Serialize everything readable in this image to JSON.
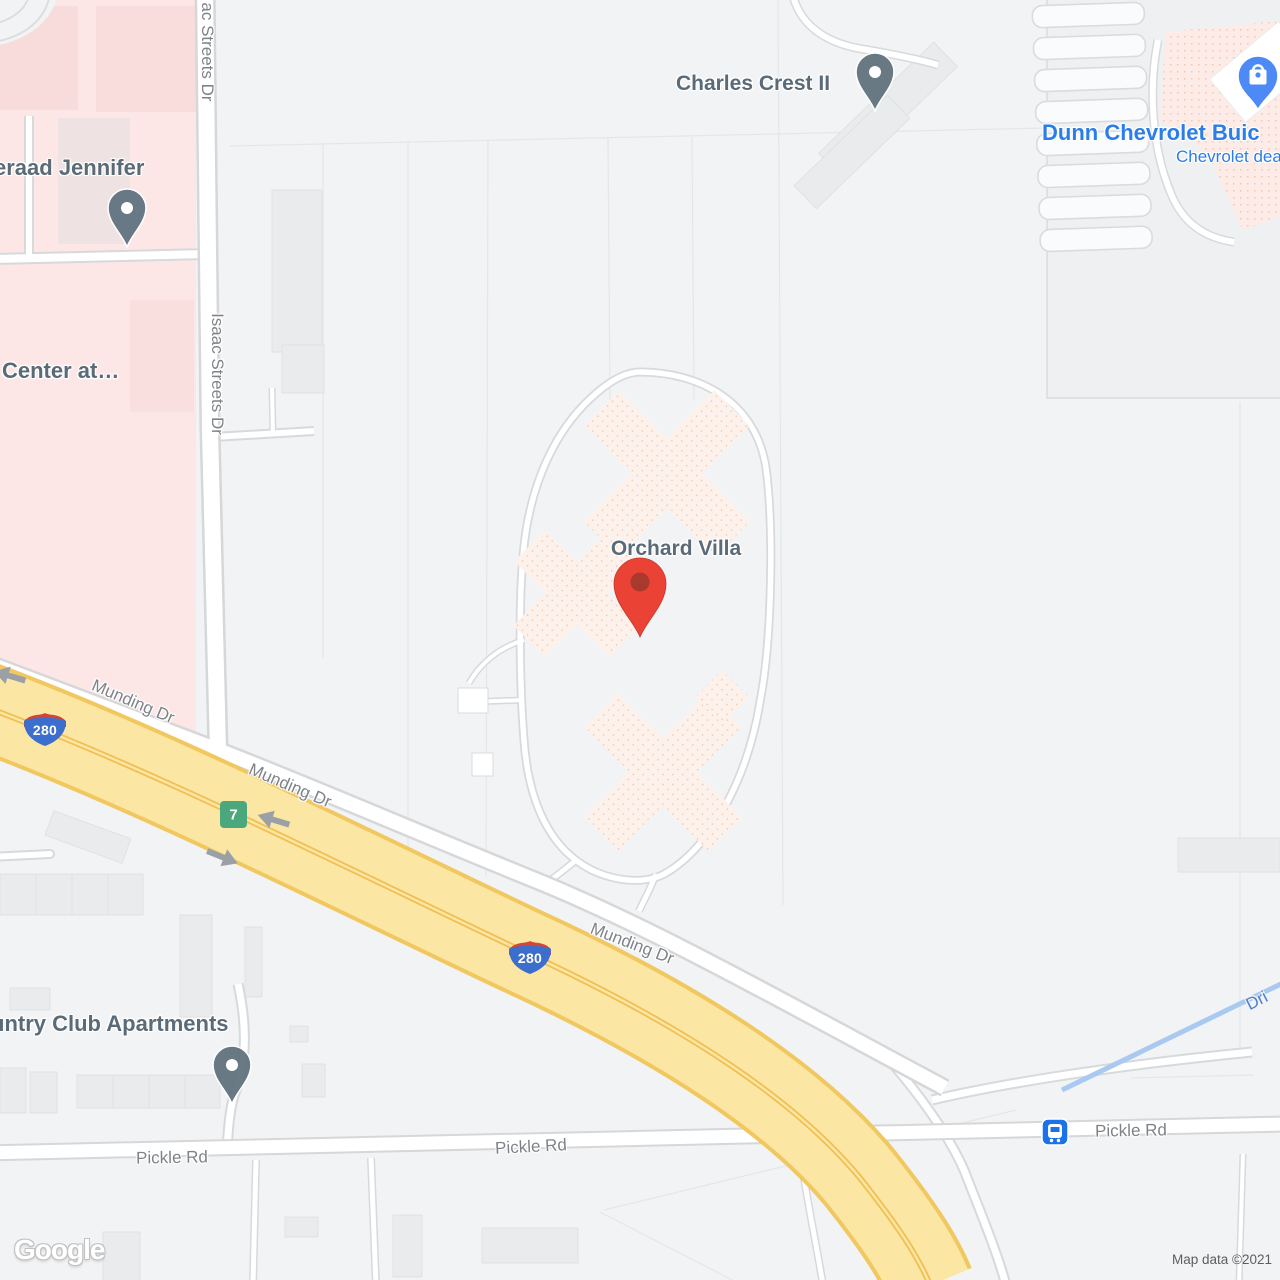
{
  "map_type": "road-map",
  "attribution": {
    "logo": "Google",
    "text": "Map data ©2021"
  },
  "labels": {
    "charles_crest": "Charles Crest II",
    "dunn_line1": "Dunn Chevrolet Buic",
    "dunn_line2": "Chevrolet dea",
    "jennifer": "eraad Jennifer",
    "center_at": "Center at…",
    "orchard_villa": "Orchard Villa",
    "country_club": "untry Club Apartments",
    "isaac_top": "ac Streets Dr",
    "isaac_mid": "Isaac Streets Dr",
    "munding_1": "Munding Dr",
    "munding_2": "Munding Dr",
    "munding_3": "Munding Dr",
    "pickle_1": "Pickle Rd",
    "pickle_2": "Pickle Rd",
    "pickle_3": "Pickle Rd",
    "water": "Dri"
  },
  "shields": {
    "interstate_a": "280",
    "interstate_b": "280",
    "exit": "7"
  },
  "markers": [
    {
      "name": "red-location-pin",
      "label": "Orchard Villa",
      "color": "#ea4335"
    },
    {
      "name": "poi-pin",
      "label": "Charles Crest II",
      "color": "#61737f"
    },
    {
      "name": "poi-pin",
      "label": "eraad Jennifer",
      "color": "#61737f"
    },
    {
      "name": "poi-pin",
      "label": "untry Club Apartments",
      "color": "#61737f"
    },
    {
      "name": "shopping-pin",
      "label": "Dunn Chevrolet Buic",
      "color": "#4d8af5"
    },
    {
      "name": "bus-station-icon",
      "color": "#1a73e8"
    },
    {
      "name": "direction-arrow",
      "count": 3,
      "color": "#9aa0a6"
    }
  ],
  "colors": {
    "background": "#f1f3f5",
    "road_fill": "#ffffff",
    "road_casing": "#d7d9db",
    "freeway_fill": "#fbe7a3",
    "freeway_casing": "#f1c75f",
    "medical_area": "#fce7e6",
    "commercial_area": "#fcebe7",
    "campus_building": "#fdf1ec",
    "building": "#e9ebec",
    "water": "#a9c9f1",
    "poi_label": "#5a6a77",
    "street_label": "#7f8388",
    "business_label": "#2b7de9",
    "water_label": "#4c7fd2",
    "pin_red": "#ea4335",
    "pin_gray": "#61737f",
    "pin_blue": "#4d8af5",
    "transit_blue": "#1a73e8",
    "exit_green": "#4aa87c",
    "shield_blue": "#3c6fcd",
    "shield_red": "#d24538",
    "attribution_text": "#5c5f62"
  }
}
